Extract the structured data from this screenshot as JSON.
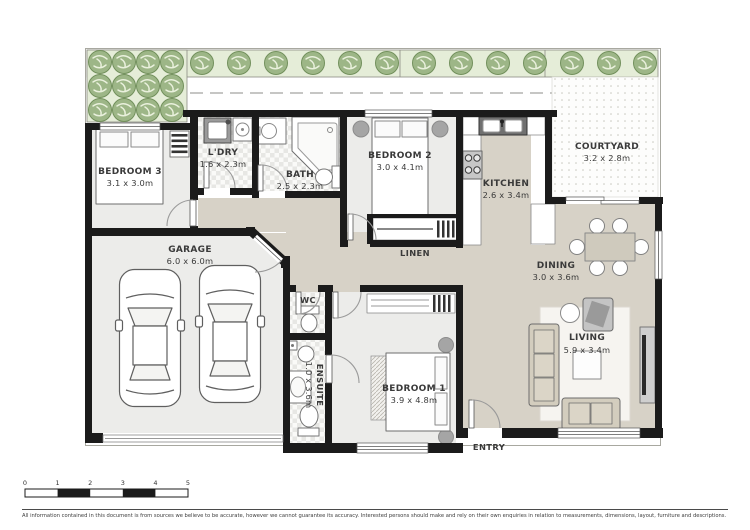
{
  "rooms": {
    "bedroom3": {
      "name": "BEDROOM 3",
      "dims": "3.1 x 3.0m"
    },
    "ldry": {
      "name": "L'DRY",
      "dims": "1.6 x 2.3m"
    },
    "bath": {
      "name": "BATH",
      "dims": "2.5 x 2.3m"
    },
    "bedroom2": {
      "name": "BEDROOM 2",
      "dims": "3.0 x 4.1m"
    },
    "kitchen": {
      "name": "KITCHEN",
      "dims": "2.6 x 3.4m"
    },
    "courtyard": {
      "name": "COURTYARD",
      "dims": "3.2 x 2.8m"
    },
    "garage": {
      "name": "GARAGE",
      "dims": "6.0 x 6.0m"
    },
    "linen": {
      "name": "LINEN"
    },
    "dining": {
      "name": "DINING",
      "dims": "3.0 x 3.6m"
    },
    "wc": {
      "name": "WC"
    },
    "ensuite": {
      "name": "ENSUITE",
      "dims": "1.0 x 3.6m"
    },
    "bedroom1": {
      "name": "BEDROOM 1",
      "dims": "3.9 x 4.8m"
    },
    "living": {
      "name": "LIVING",
      "dims": "5.9 x 3.4m"
    },
    "entry": {
      "name": "ENTRY"
    }
  },
  "scale_bar": {
    "ticks": [
      "0",
      "1",
      "2",
      "3",
      "4",
      "5"
    ]
  },
  "footer": {
    "disclaimer": "All information contained in this document is from sources we believe to be accurate, however we cannot guarantee its accuracy. Interested persons should make and rely on their own enquiries in relation to measurements, dimensions, layout, furniture and descriptions."
  },
  "colors": {
    "wall": "#1b1b1b",
    "floor_open": "#d7d2c7",
    "floor_room": "#ececea",
    "tree": "#9db687",
    "tree_bed": "#e5edd8",
    "accent_gray": "#a5a5a5"
  }
}
